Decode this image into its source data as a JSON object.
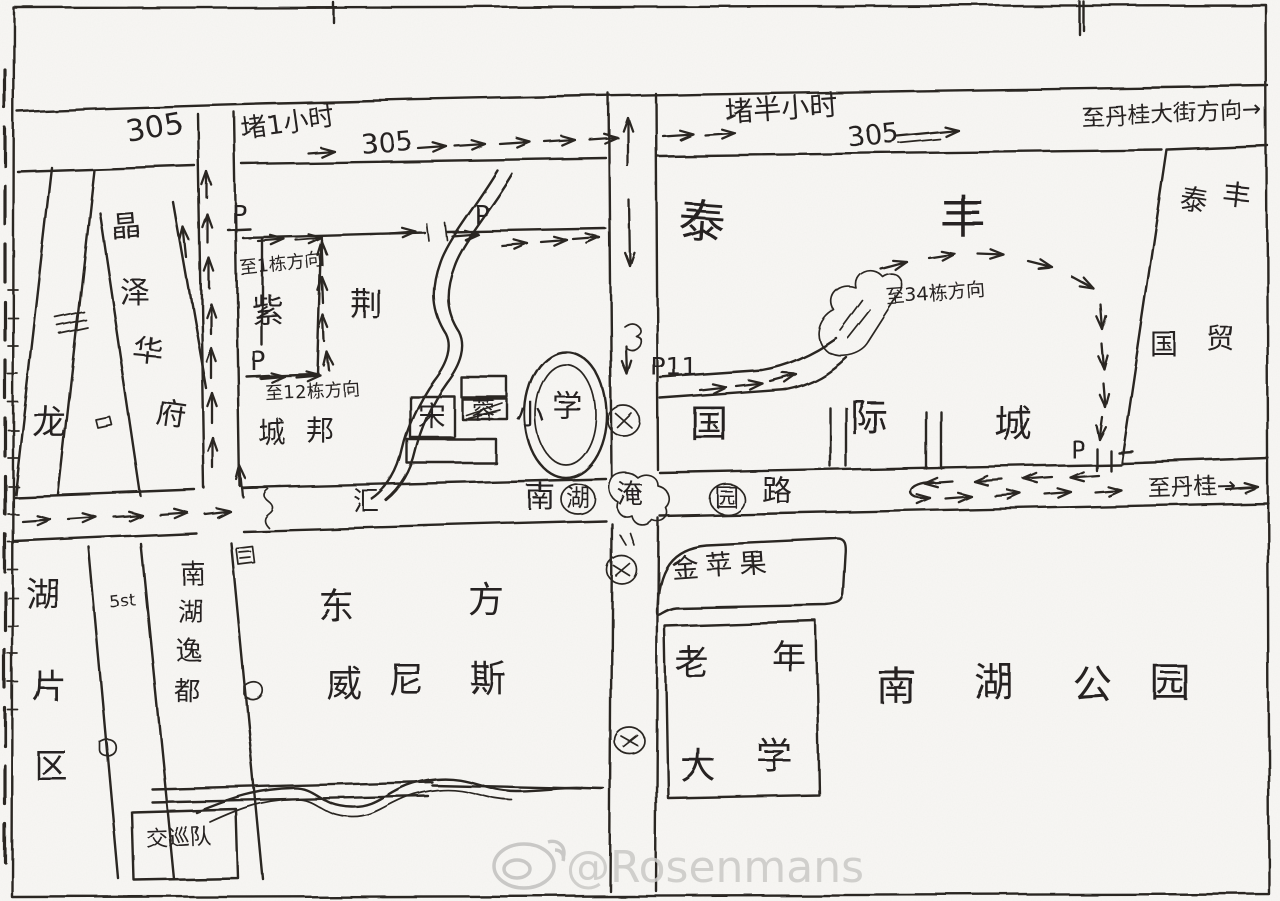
{
  "labels": {
    "bus305_a": "305",
    "jam_1h": "堵1小时",
    "bus305_b": "305",
    "jam_half_hour": "堵半小时",
    "bus305_c": "305",
    "to_dangui_avenue": "至丹桂大街方向→",
    "p": "P",
    "p11": "P11",
    "to_building_1": "至1栋方向",
    "to_building_12": "至12栋方向",
    "to_building_34": "至34栋方向",
    "to_dangui": "至丹桂→",
    "hui": "汇",
    "flood_note": "淹",
    "note_5st": "5st",
    "jiaoxun_team": "交巡队",
    "golden_apple": "金苹果"
  },
  "places": {
    "long": "龙",
    "hu_pian_qu": [
      "湖",
      "片",
      "区"
    ],
    "jing_ze_hua_fu": [
      "晶",
      "泽",
      "华",
      "府"
    ],
    "zi_jing_cheng_bang": [
      "紫",
      "荆",
      "城",
      "邦"
    ],
    "school": [
      "宋",
      "蓉",
      "小",
      "学"
    ],
    "tai_feng": [
      "泰",
      "丰"
    ],
    "guo_ji_cheng": [
      "国",
      "际",
      "城"
    ],
    "tai_feng_guo_mao": [
      "泰",
      "丰",
      "国",
      "贸"
    ],
    "nan_hu_yi_du": [
      "南",
      "湖",
      "逸",
      "都"
    ],
    "dong_fang_wei_ni_si": [
      "东",
      "方",
      "威",
      "尼",
      "斯"
    ],
    "lao_nian_da_xue": [
      "老",
      "年",
      "大",
      "学"
    ],
    "nan_hu_gong_yuan": [
      "南",
      "湖",
      "公",
      "园"
    ],
    "road_name": [
      "南",
      "湖",
      "园",
      "路"
    ]
  },
  "watermark": {
    "handle": "@Rosenmans"
  }
}
